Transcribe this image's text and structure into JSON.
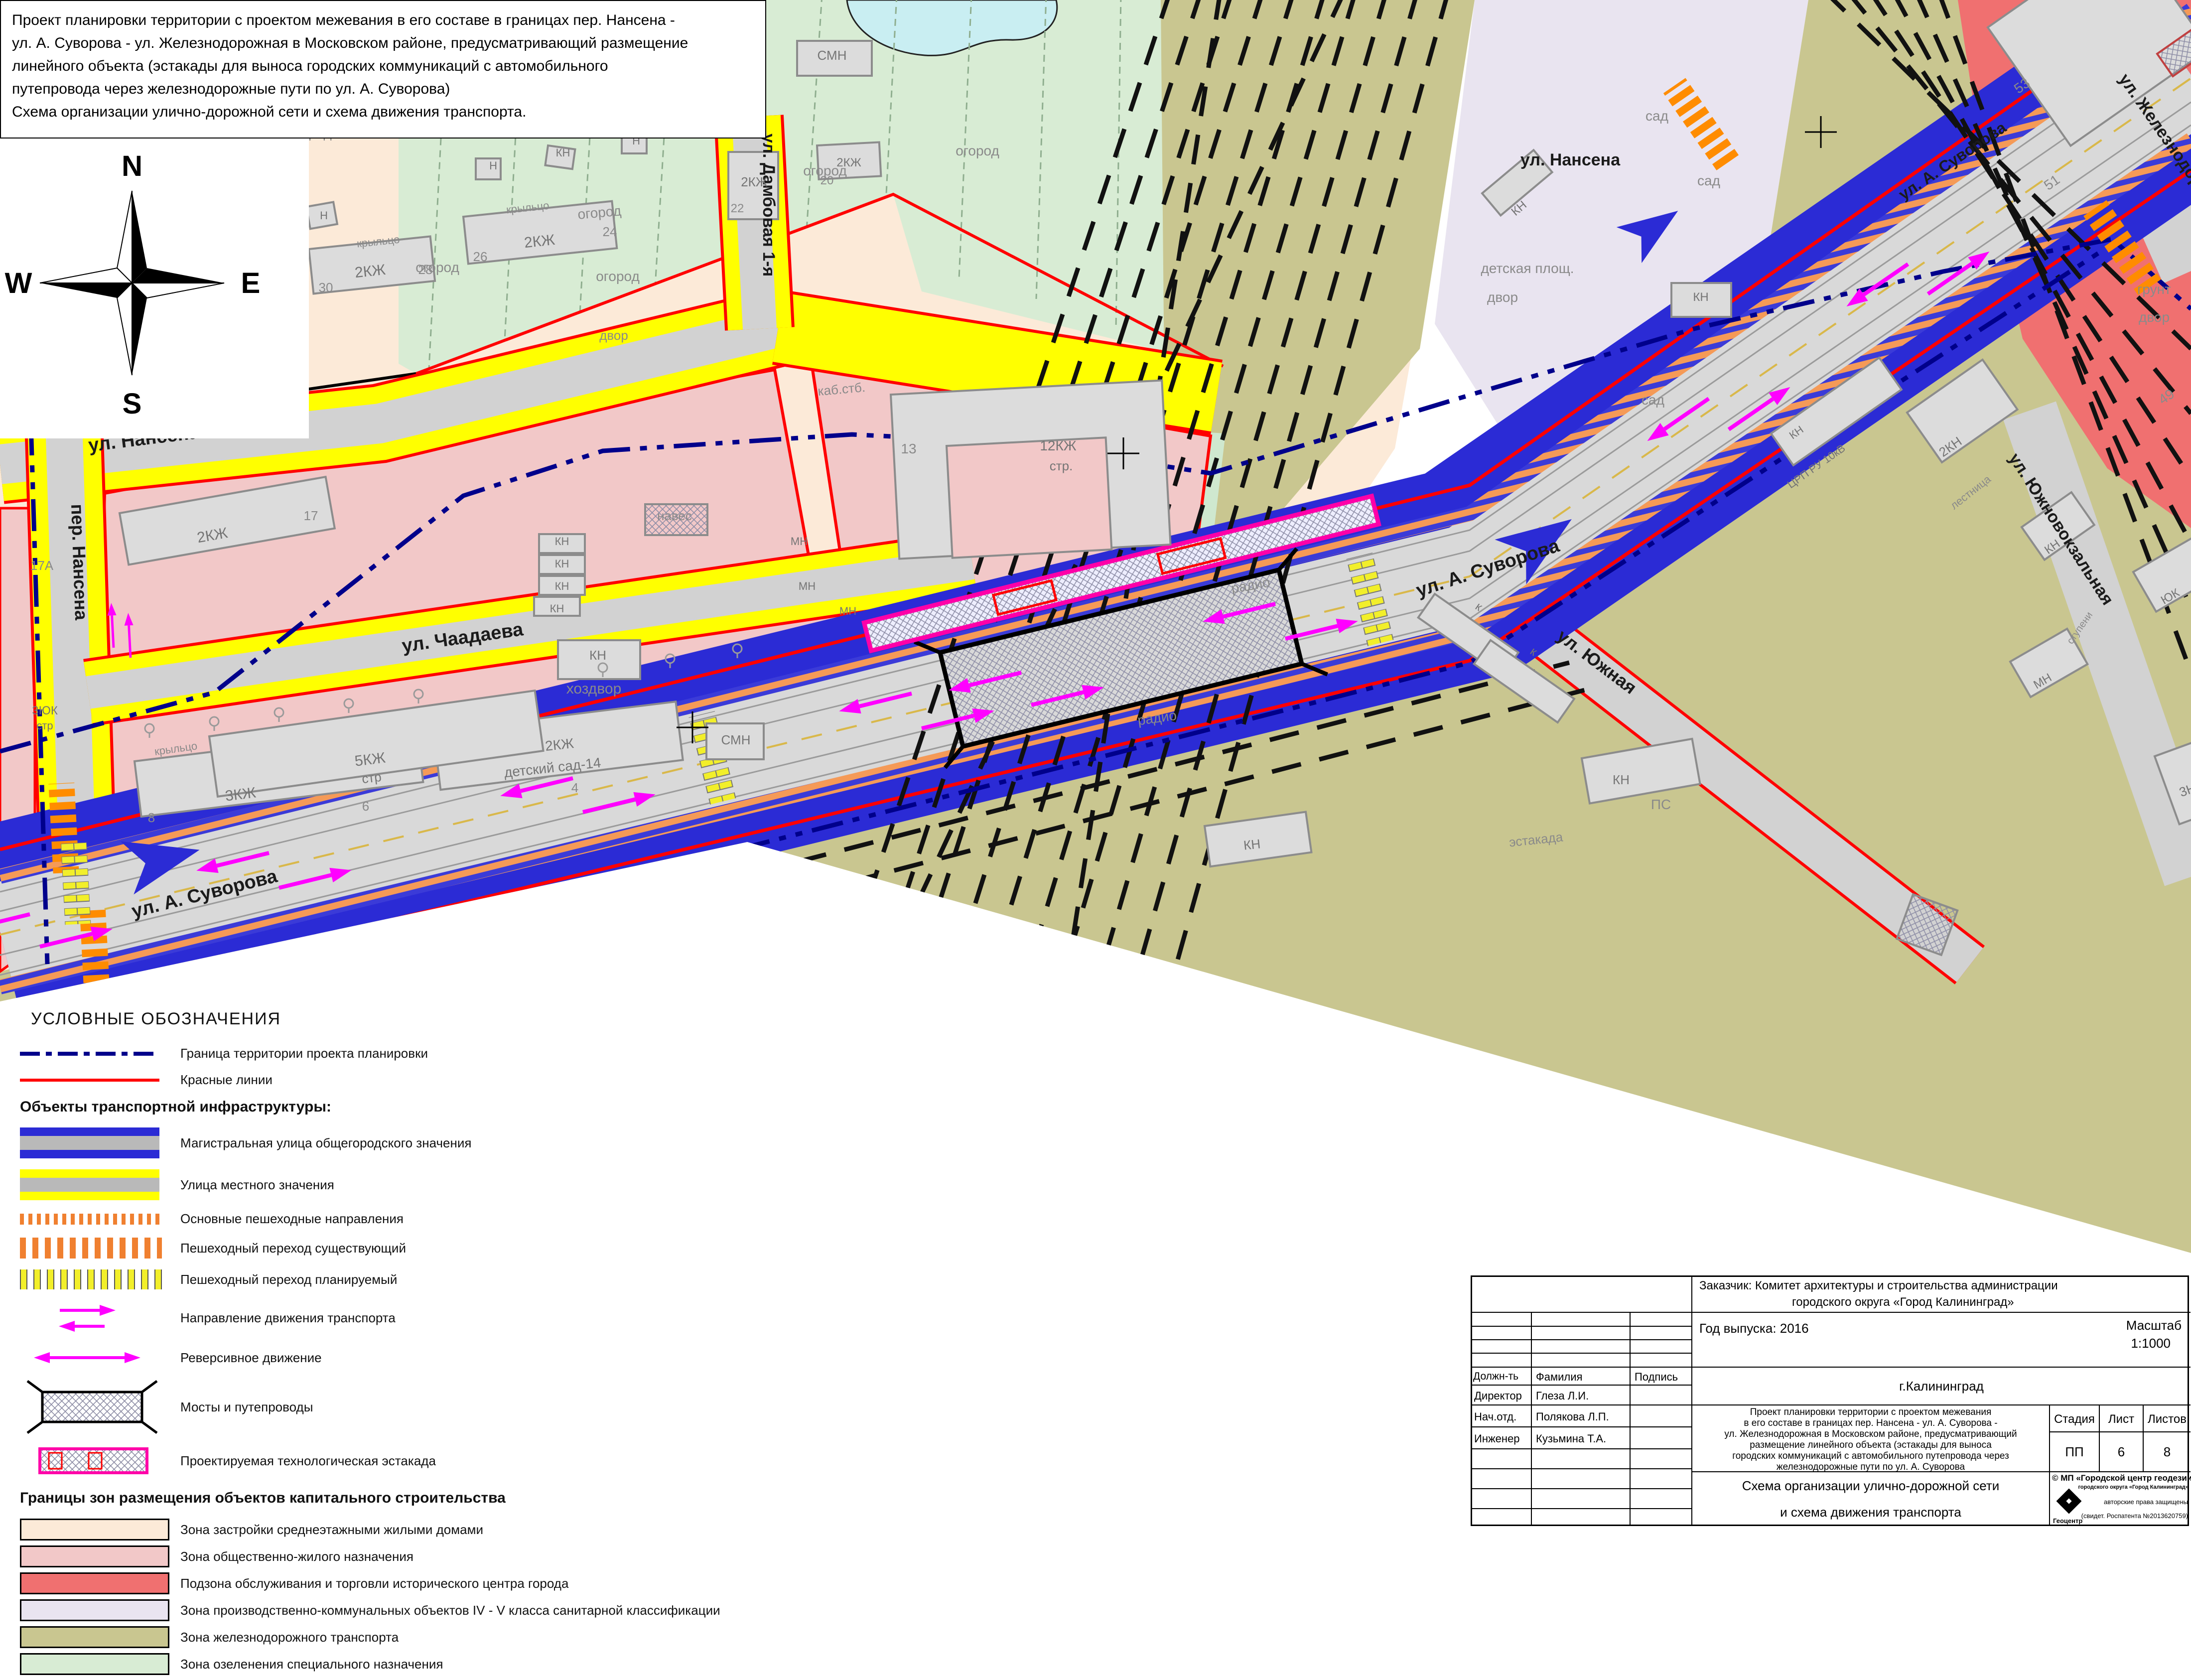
{
  "title_block": {
    "lines": [
      "Проект планировки территории с проектом межевания в его составе в границах пер. Нансена -",
      "ул. А. Суворова - ул. Железнодорожная в Московском районе, предусматривающий размещение",
      "линейного объекта (эстакады для выноса городских коммуникаций с автомобильного",
      "путепровода через железнодорожные пути по ул. А. Суворова)",
      "Схема организации улично-дорожной сети и схема движения транспорта."
    ]
  },
  "compass": {
    "n": "N",
    "s": "S",
    "w": "W",
    "e": "E"
  },
  "colors": {
    "zone_midrise": "#fcead8",
    "zone_public_residential": "#f2c8c8",
    "zone_trade_subzone": "#f07070",
    "zone_industrial": "#e9e4f0",
    "zone_railway": "#c9c690",
    "zone_green_special": "#d8ecd4",
    "main_street_blue": "#2b2bd5",
    "local_street_yellow": "#ffff00",
    "pedestrian_orange": "#f08030",
    "traffic_magenta": "#ff00ff",
    "red_line": "#ff0000",
    "boundary_navy": "#00008b",
    "road_gray": "#d9d9d9",
    "water": "#c9eef2"
  },
  "legend": {
    "title": "УСЛОВНЫЕ ОБОЗНАЧЕНИЯ",
    "general": [
      {
        "label": "Граница территории проекта планировки"
      },
      {
        "label": "Красные линии"
      }
    ],
    "transport_header": "Объекты транспортной инфраструктуры:",
    "transport": [
      {
        "label": "Магистральная улица общегородского значения"
      },
      {
        "label": "Улица местного значения"
      },
      {
        "label": "Основные пешеходные направления"
      },
      {
        "label": "Пешеходный переход существующий"
      },
      {
        "label": "Пешеходный переход планируемый"
      },
      {
        "label": "Направление движения транспорта"
      },
      {
        "label": "Реверсивное движение"
      },
      {
        "label": "Мосты и путепроводы"
      },
      {
        "label": "Проектируемая технологическая эстакада"
      }
    ],
    "zones_header": "Границы зон размещения объектов капитального строительства",
    "zones": [
      {
        "label": "Зона застройки среднеэтажными жилыми домами",
        "color": "#fcead8"
      },
      {
        "label": "Зона общественно-жилого назначения",
        "color": "#f2c8c8"
      },
      {
        "label": "Подзона обслуживания и торговли исторического центра города",
        "color": "#f07070"
      },
      {
        "label": "Зона производственно-коммунальных объектов IV - V класса санитарной классификации",
        "color": "#e9e4f0"
      },
      {
        "label": "Зона железнодорожного транспорта",
        "color": "#c9c690"
      },
      {
        "label": "Зона озеленения специального назначения",
        "color": "#d8ecd4"
      }
    ]
  },
  "stamp": {
    "customer_line1": "Заказчик: Комитет архитектуры и строительства администрации",
    "customer_line2": "городского округа «Город Калининград»",
    "year": "Год выпуска: 2016",
    "scale_label": "Масштаб",
    "scale_value": "1:1000",
    "city": "г.Калининград",
    "col_position": "Должн-ть",
    "col_name": "Фамилия",
    "col_sign": "Подпись",
    "rows": [
      {
        "position": "Директор",
        "name": "Глеза Л.И."
      },
      {
        "position": "Нач.отд.",
        "name": "Полякова Л.П."
      },
      {
        "position": "Инженер",
        "name": "Кузьмина Т.А."
      }
    ],
    "project_lines": [
      "Проект планировки территории с проектом межевания",
      "в его составе в границах пер. Нансена - ул. А. Суворова -",
      "ул. Железнодорожная в Московском районе, предусматривающий",
      "размещение линейного объекта  (эстакады для выноса",
      "городских коммуникаций с автомобильного путепровода через",
      "железнодорожные пути по ул. А. Суворова"
    ],
    "stage_label": "Стадия",
    "sheet_label": "Лист",
    "sheets_label": "Листов",
    "stage": "ПП",
    "sheet": "6",
    "sheets": "8",
    "org_line": "© МП «Городской центр геодезии»",
    "org_sub": "городского округа «Город Калининград»",
    "logo_caption": "Геоцентр",
    "rights1": "авторские права защищены",
    "rights2": "(свидет. Роспатента №2013620759)",
    "scheme_line1": "Схема организации улично-дорожной сети",
    "scheme_line2": "и схема движения транспорта"
  },
  "map": {
    "labels": [
      {
        "t": "ул. Нансена"
      },
      {
        "t": "ул. Дамбовая 1-я"
      },
      {
        "t": "ул. Чаадаева"
      },
      {
        "t": "пер. Нансена"
      },
      {
        "t": "ул. А. Суворова"
      },
      {
        "t": "ул. А. Суворова"
      },
      {
        "t": "ул. А. Суворова"
      },
      {
        "t": "ул. Южная"
      },
      {
        "t": "ул. Южновокзальная"
      },
      {
        "t": "ул. Железнодорожная"
      },
      {
        "t": "ул. Нансена"
      },
      {
        "t": "огород"
      },
      {
        "t": "огороды"
      },
      {
        "t": "огород"
      },
      {
        "t": "огород"
      },
      {
        "t": "огород"
      },
      {
        "t": "огород"
      },
      {
        "t": "огород"
      },
      {
        "t": "огород"
      },
      {
        "t": "сад"
      },
      {
        "t": "сад"
      },
      {
        "t": "сад"
      },
      {
        "t": "детская площ."
      },
      {
        "t": "двор"
      },
      {
        "t": "двор"
      },
      {
        "t": "хоздвор"
      },
      {
        "t": "навес"
      },
      {
        "t": "крыльцо"
      },
      {
        "t": "крыльцо"
      },
      {
        "t": "крыльцо"
      },
      {
        "t": "крыльцо"
      },
      {
        "t": "радио"
      },
      {
        "t": "радио"
      },
      {
        "t": "ПС"
      },
      {
        "t": "грунт"
      },
      {
        "t": "двор"
      },
      {
        "t": "каб.стб."
      },
      {
        "t": "эстакада"
      },
      {
        "t": "лестница"
      },
      {
        "t": "ступени"
      },
      {
        "t": "детский сад-14"
      },
      {
        "t": "2КЖ"
      },
      {
        "t": "34"
      },
      {
        "t": "2КЖ"
      },
      {
        "t": "32"
      },
      {
        "t": "2КЖ"
      },
      {
        "t": "30"
      },
      {
        "t": "28"
      },
      {
        "t": "2КЖ"
      },
      {
        "t": "26"
      },
      {
        "t": "24"
      },
      {
        "t": "2КЖ"
      },
      {
        "t": "22"
      },
      {
        "t": "2КЖ"
      },
      {
        "t": "20"
      },
      {
        "t": "СМН"
      },
      {
        "t": "Н"
      },
      {
        "t": "Н"
      },
      {
        "t": "КН"
      },
      {
        "t": "Н"
      },
      {
        "t": "КН"
      },
      {
        "t": "2КЖ"
      },
      {
        "t": "17А"
      },
      {
        "t": "17"
      },
      {
        "t": "КН"
      },
      {
        "t": "КН"
      },
      {
        "t": "КН"
      },
      {
        "t": "КН"
      },
      {
        "t": "КН"
      },
      {
        "t": "3КЖ"
      },
      {
        "t": "8"
      },
      {
        "t": "6"
      },
      {
        "t": "2КЖ"
      },
      {
        "t": "4"
      },
      {
        "t": "5КЖ"
      },
      {
        "t": "стр"
      },
      {
        "t": "СМН"
      },
      {
        "t": "13"
      },
      {
        "t": "12КЖ"
      },
      {
        "t": "стр."
      },
      {
        "t": "МН"
      },
      {
        "t": "МН"
      },
      {
        "t": "МН"
      },
      {
        "t": "КН"
      },
      {
        "t": "к"
      },
      {
        "t": "к"
      },
      {
        "t": "КН"
      },
      {
        "t": "КН"
      },
      {
        "t": "КН"
      },
      {
        "t": "КН"
      },
      {
        "t": "ЦРП РУ 10кВ"
      },
      {
        "t": "2КН"
      },
      {
        "t": "КН"
      },
      {
        "t": "ЮК"
      },
      {
        "t": "МН"
      },
      {
        "t": "3Н"
      },
      {
        "t": "53"
      },
      {
        "t": "51"
      },
      {
        "t": "49"
      },
      {
        "t": "2ЮК"
      },
      {
        "t": "2ЮК"
      },
      {
        "t": "3ЮК"
      },
      {
        "t": "стр"
      },
      {
        "t": "Н"
      },
      {
        "t": "КН"
      }
    ]
  }
}
